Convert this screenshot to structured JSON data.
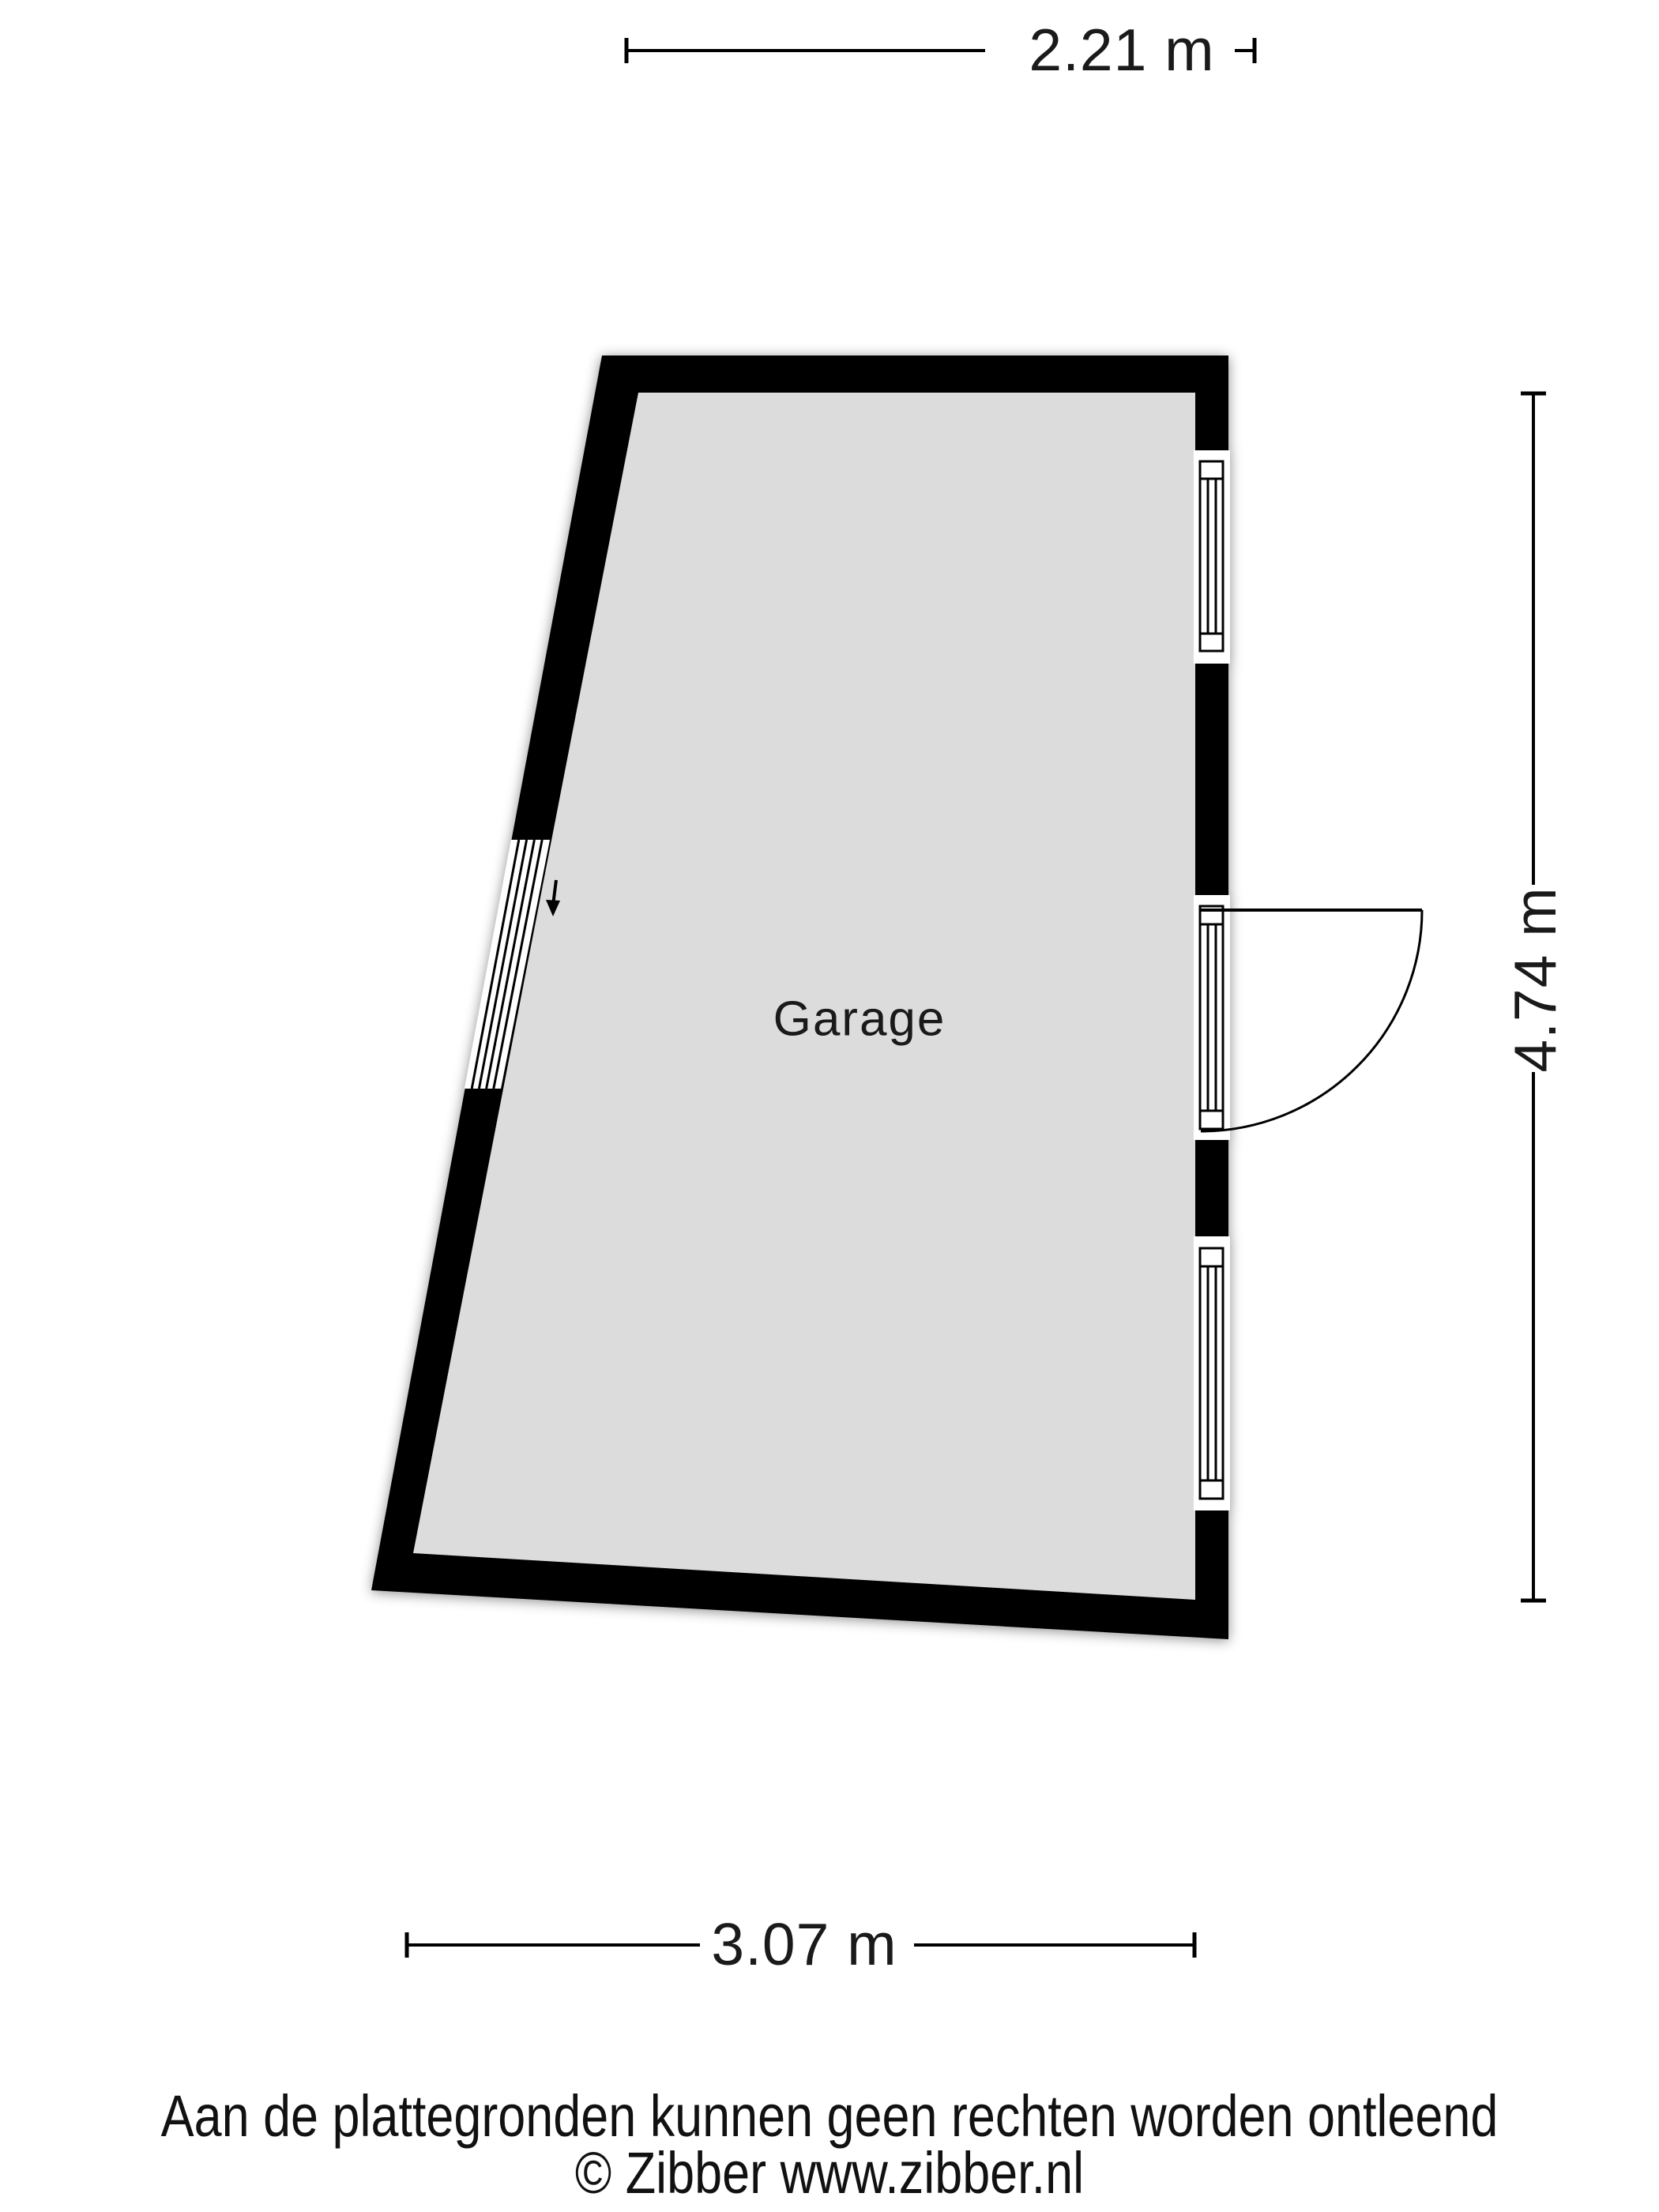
{
  "floorplan": {
    "room": {
      "label": "Garage"
    },
    "dimensions": {
      "top": "2.21 m",
      "right": "4.74 m",
      "bottom": "3.07 m"
    }
  },
  "footer": {
    "disclaimer": "Aan de plattegronden kunnen geen rechten worden ontleend",
    "copyright": "© Zibber www.zibber.nl"
  },
  "icons": {
    "entry_arrow": "down-arrow"
  },
  "colors": {
    "wall": "#000000",
    "floor": "#dcdcdc",
    "opening": "#ffffff",
    "line": "#000000",
    "text": "#1a1a1a",
    "background": "#ffffff"
  }
}
